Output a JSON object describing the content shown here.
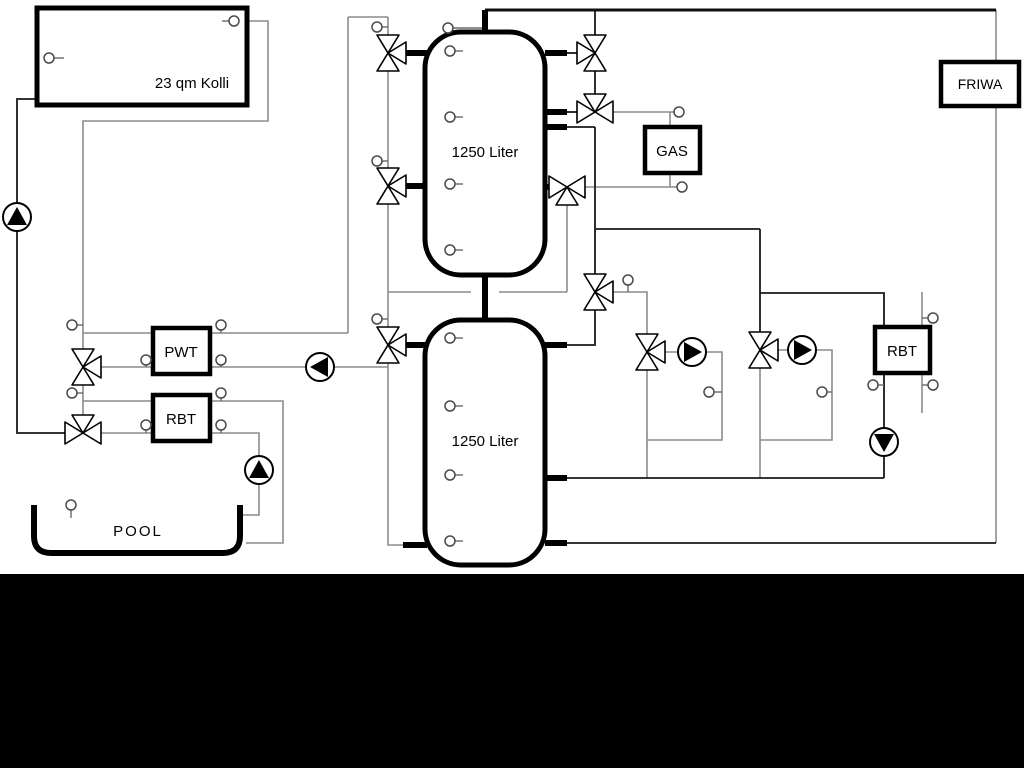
{
  "labels": {
    "collector": "23 qm Kolli",
    "tank_top": "1250 Liter",
    "tank_bottom": "1250 Liter",
    "pwt": "PWT",
    "rbt_left": "RBT",
    "gas": "GAS",
    "friwa": "FRIWA",
    "rbt_right": "RBT",
    "pool": "POOL"
  },
  "colors": {
    "background": "#ffffff",
    "footer_bar": "#000000",
    "outline": "#000000",
    "pipe_dark": "#1a1a1a",
    "pipe_gray": "#8c8c8c",
    "sensor_stroke": "#4a4a4a"
  },
  "icons": {
    "pump": "circle-with-solid-triangle",
    "three_way_valve": "triangle-bowtie",
    "sensor": "small-circle-with-tick"
  }
}
